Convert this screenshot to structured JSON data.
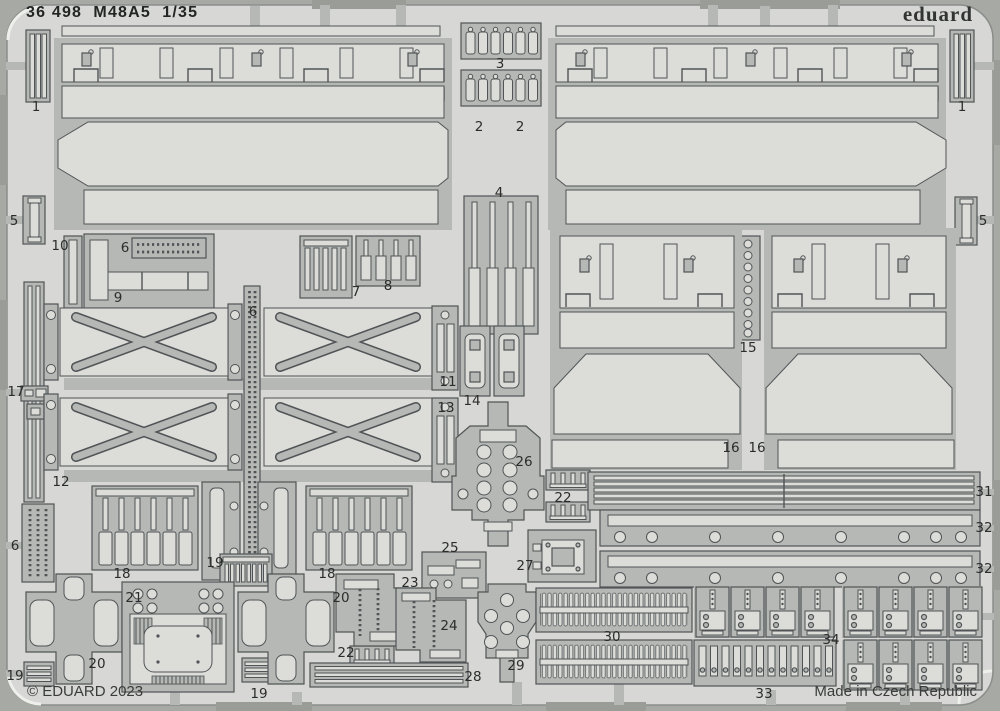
{
  "header": {
    "title": "36 498  M48A5  1/35",
    "brand": "eduard"
  },
  "footer": {
    "copyright": "© EDUARD 2023",
    "made_in": "Made in Czech Republic"
  },
  "colors": {
    "bg-outer": "#a7a9a5",
    "plate": "#d7d8d5",
    "part": "#b5b8b4",
    "light": "#dcddd9",
    "line": "#505456",
    "rim": "#9a9c98",
    "text": "#2b2d2c",
    "highlight": "#eef0ec"
  },
  "part_labels": [
    {
      "n": "1",
      "x": 36,
      "y": 107
    },
    {
      "n": "3",
      "x": 500,
      "y": 64
    },
    {
      "n": "2",
      "x": 479,
      "y": 127
    },
    {
      "n": "2",
      "x": 520,
      "y": 127
    },
    {
      "n": "1",
      "x": 962,
      "y": 107
    },
    {
      "n": "5",
      "x": 14,
      "y": 221
    },
    {
      "n": "4",
      "x": 499,
      "y": 193
    },
    {
      "n": "5",
      "x": 983,
      "y": 221
    },
    {
      "n": "10",
      "x": 60,
      "y": 246
    },
    {
      "n": "6",
      "x": 125,
      "y": 248
    },
    {
      "n": "9",
      "x": 118,
      "y": 298
    },
    {
      "n": "7",
      "x": 356,
      "y": 292
    },
    {
      "n": "8",
      "x": 388,
      "y": 286
    },
    {
      "n": "6",
      "x": 253,
      "y": 312
    },
    {
      "n": "17",
      "x": 16,
      "y": 392
    },
    {
      "n": "11",
      "x": 448,
      "y": 382
    },
    {
      "n": "13",
      "x": 446,
      "y": 408
    },
    {
      "n": "14",
      "x": 472,
      "y": 401
    },
    {
      "n": "15",
      "x": 748,
      "y": 348
    },
    {
      "n": "12",
      "x": 61,
      "y": 482
    },
    {
      "n": "16",
      "x": 731,
      "y": 448
    },
    {
      "n": "16",
      "x": 757,
      "y": 448
    },
    {
      "n": "26",
      "x": 524,
      "y": 462
    },
    {
      "n": "22",
      "x": 563,
      "y": 498
    },
    {
      "n": "31",
      "x": 984,
      "y": 492
    },
    {
      "n": "32",
      "x": 984,
      "y": 528
    },
    {
      "n": "32",
      "x": 984,
      "y": 569
    },
    {
      "n": "6",
      "x": 15,
      "y": 546
    },
    {
      "n": "18",
      "x": 122,
      "y": 574
    },
    {
      "n": "19",
      "x": 215,
      "y": 563
    },
    {
      "n": "18",
      "x": 327,
      "y": 574
    },
    {
      "n": "25",
      "x": 450,
      "y": 548
    },
    {
      "n": "27",
      "x": 525,
      "y": 566
    },
    {
      "n": "21",
      "x": 134,
      "y": 598
    },
    {
      "n": "20",
      "x": 341,
      "y": 598
    },
    {
      "n": "23",
      "x": 410,
      "y": 583
    },
    {
      "n": "24",
      "x": 449,
      "y": 626
    },
    {
      "n": "22",
      "x": 346,
      "y": 653
    },
    {
      "n": "20",
      "x": 97,
      "y": 664
    },
    {
      "n": "28",
      "x": 473,
      "y": 677
    },
    {
      "n": "29",
      "x": 516,
      "y": 666
    },
    {
      "n": "30",
      "x": 612,
      "y": 637
    },
    {
      "n": "34",
      "x": 831,
      "y": 640
    },
    {
      "n": "33",
      "x": 764,
      "y": 694
    },
    {
      "n": "19",
      "x": 15,
      "y": 676
    },
    {
      "n": "19",
      "x": 259,
      "y": 694
    }
  ]
}
